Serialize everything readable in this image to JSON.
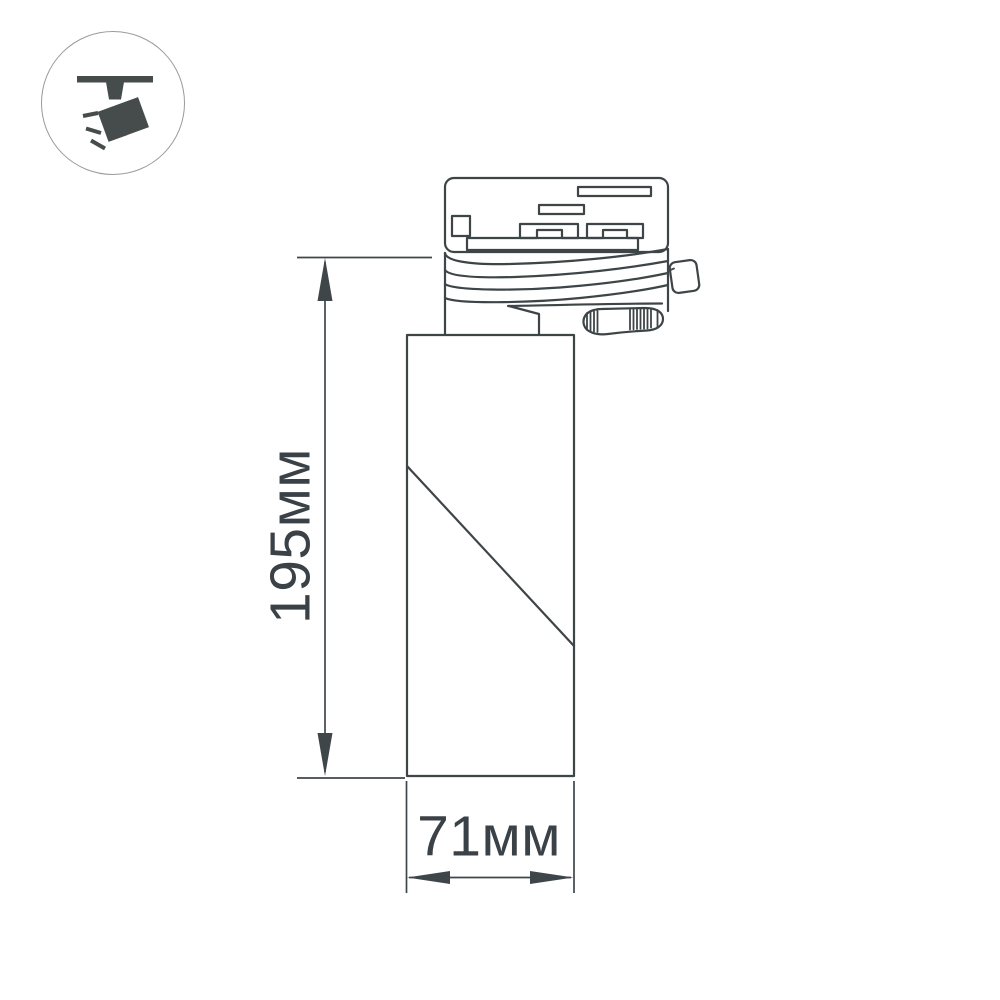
{
  "page": {
    "title": "Luminaire dimensional drawing"
  },
  "colors": {
    "background": "#ffffff",
    "line": "#3e4547",
    "dimension": "#3f464a",
    "label_text": "#3b4247",
    "icon_glyph": "#454c4b",
    "badge_border": "#9a9a9a"
  },
  "badge": {
    "icon": "track-spotlight-icon"
  },
  "drawing": {
    "subject": "track-mounted cylindrical spotlight, side view",
    "dimensions": {
      "height": {
        "label": "195мм",
        "value": 195,
        "unit": "мм",
        "orientation": "vertical"
      },
      "width": {
        "label": "71мм",
        "value": 71,
        "unit": "мм",
        "orientation": "horizontal"
      }
    }
  }
}
